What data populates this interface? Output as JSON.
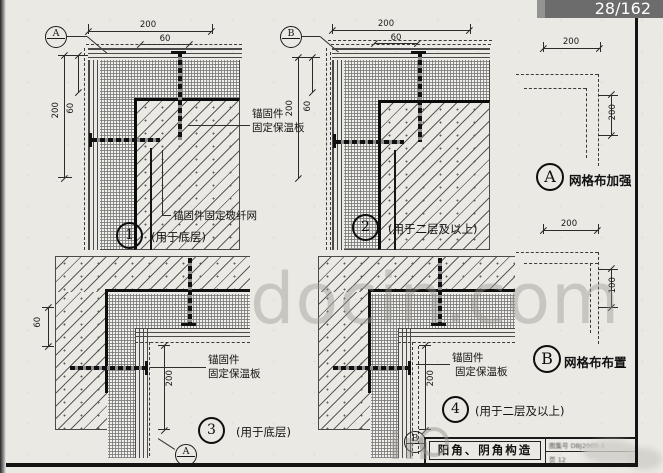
{
  "viewer": {
    "page_indicator": "28/162"
  },
  "watermark": {
    "main": "docin.com",
    "fragment": "in"
  },
  "drawing1": {
    "marker": "A",
    "dim_top": "200",
    "dim_top_inner": "60",
    "dim_left": "200",
    "dim_left_inner": "60",
    "anchor_label_1": "锚固件",
    "anchor_label_2": "固定保温板",
    "mesh_label": "锚固件固定玻纤网",
    "number": "1",
    "caption": "(用于底层)"
  },
  "drawing2": {
    "marker": "B",
    "dim_top": "200",
    "dim_top_inner": "60",
    "dim_left": "200",
    "dim_left_inner": "60",
    "number": "2",
    "caption": "(用于二层及以上)"
  },
  "drawing3": {
    "dim_left": "60",
    "dim_inner": "200",
    "anchor_label_1": "锚固件",
    "anchor_label_2": "固定保温板",
    "number": "3",
    "caption": "(用于底层)",
    "marker": "A"
  },
  "drawing4": {
    "dim_inner": "200",
    "anchor_label_1": "锚固件",
    "anchor_label_2": "固定保温板",
    "number": "4",
    "caption": "(用于二层及以上)",
    "marker": "B"
  },
  "detailA": {
    "letter": "A",
    "label": "网格布加强",
    "dim_top": "200",
    "dim_right": "200"
  },
  "detailB": {
    "letter": "B",
    "label": "网格布布置",
    "dim_top": "200",
    "dim_right": "100"
  },
  "titleblock": {
    "title": "阳角、阴角构造",
    "atlas_label": "图集号",
    "atlas_no": "DBJ2005-1",
    "page_label": "页",
    "page_no": "12"
  }
}
